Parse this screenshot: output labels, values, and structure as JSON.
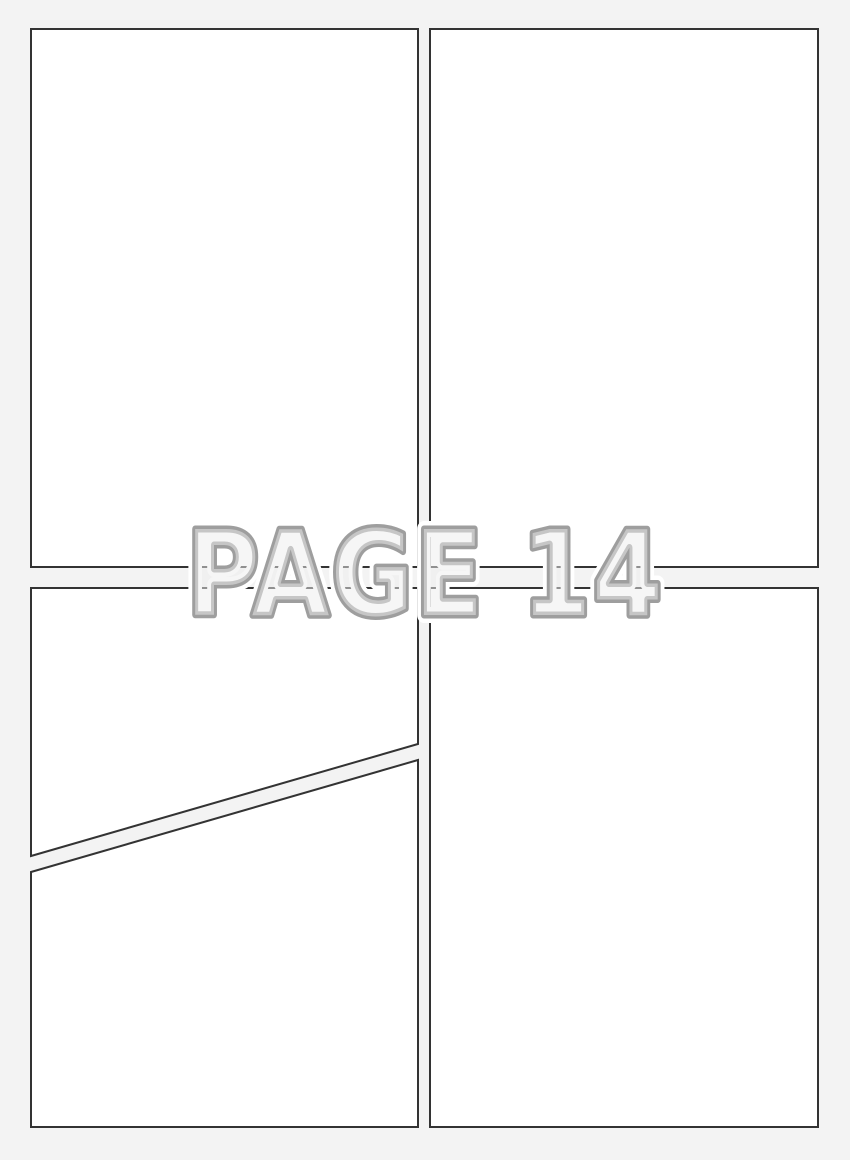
{
  "watermark": {
    "label": "PAGE 14"
  },
  "colors": {
    "page_background": "#f3f3f3",
    "panel_fill": "#ffffff",
    "panel_border": "#333333",
    "watermark_outline": "#9e9e9e",
    "watermark_halo": "#ffffff",
    "watermark_fill": "#ededed"
  },
  "panels": [
    {
      "name": "panel-top-left",
      "shape": "rectangle",
      "content": ""
    },
    {
      "name": "panel-top-right",
      "shape": "rectangle",
      "content": ""
    },
    {
      "name": "panel-bottom-left-upper",
      "shape": "quadrilateral-diagonal-bottom",
      "content": ""
    },
    {
      "name": "panel-bottom-left-lower",
      "shape": "quadrilateral-diagonal-top",
      "content": ""
    },
    {
      "name": "panel-bottom-right",
      "shape": "rectangle",
      "content": ""
    }
  ]
}
